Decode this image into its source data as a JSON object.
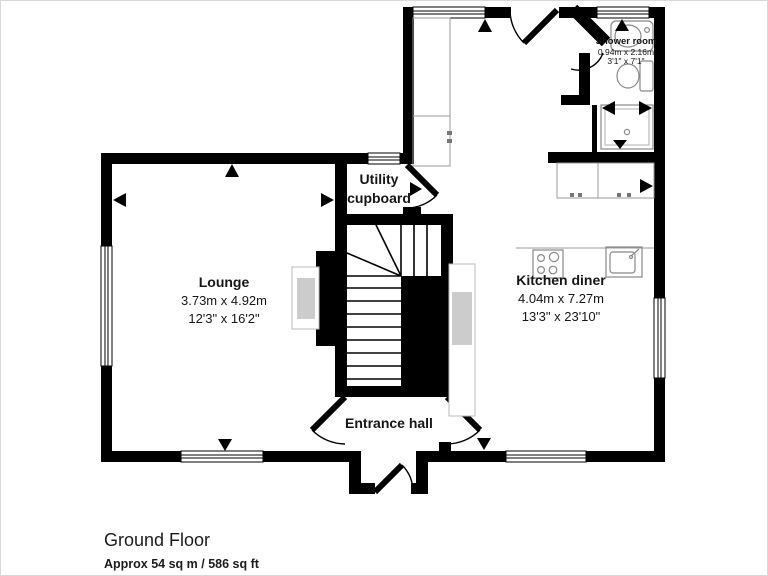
{
  "plan": {
    "rooms": [
      {
        "id": "lounge",
        "name": "Lounge",
        "metric": "3.73m x 4.92m",
        "imperial": "12'3\" x 16'2\""
      },
      {
        "id": "kitchen_diner",
        "name": "Kitchen diner",
        "metric": "4.04m x 7.27m",
        "imperial": "13'3\" x 23'10\""
      },
      {
        "id": "shower_room",
        "name": "Shower room",
        "metric": "0.94m x 2.16m",
        "imperial": "3'1\" x 7'1\""
      },
      {
        "id": "utility_cupboard",
        "name": "Utility cupboard"
      },
      {
        "id": "entrance_hall",
        "name": "Entrance hall"
      }
    ],
    "fixtures": [
      "staircase",
      "hob",
      "sink",
      "basin",
      "toilet",
      "shower-tray",
      "kitchen-counter",
      "kitchen-cabinets",
      "sofa",
      "chimney-breast",
      "windows",
      "door-swings",
      "dimension-arrows"
    ],
    "colors": {
      "wall": "#000000",
      "background": "#ffffff",
      "fixture_outline": "#999999",
      "fixture_light": "#bbbbbb",
      "fixture_fill": "#cccccc",
      "page_border": "#d9d9d9"
    }
  },
  "footer": {
    "floor_label": "Ground Floor",
    "area_label": "Approx 54 sq m / 586 sq ft"
  }
}
